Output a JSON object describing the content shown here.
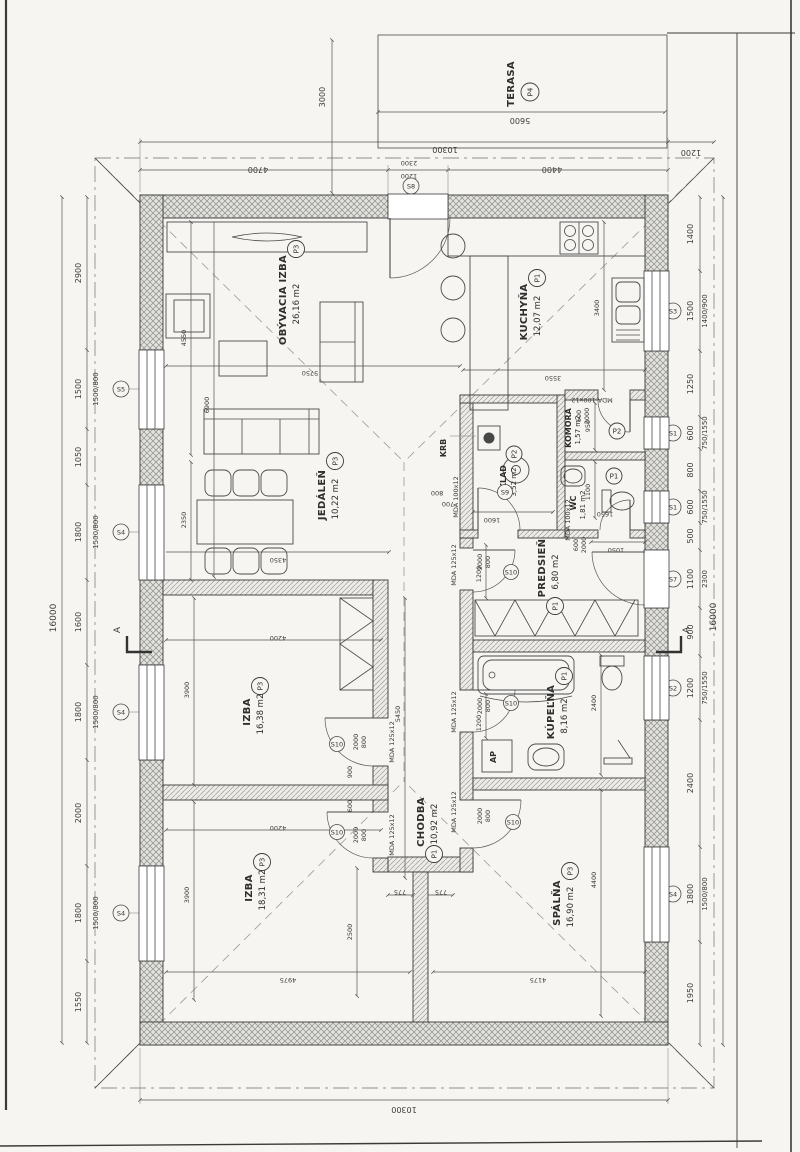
{
  "rooms": {
    "obyvacia": {
      "name": "OBÝVACIA IZBA",
      "tag": "P3",
      "area": "26,16 m2"
    },
    "kuchyna": {
      "name": "KUCHYŇA",
      "tag": "P1",
      "area": "12,07 m2"
    },
    "jedalen": {
      "name": "JEDÁLEŇ",
      "tag": "P3",
      "area": "10,22 m2"
    },
    "sklad": {
      "name": "SKLAD",
      "tag": "P2",
      "area": "3,52 m2"
    },
    "komora": {
      "name": "KOMORA",
      "tag": "P2",
      "area": "1,57 m2"
    },
    "wc": {
      "name": "WC",
      "tag": "P1",
      "area": "1,81 m2"
    },
    "predsien": {
      "name": "PREDSIEŇ",
      "tag": "P1",
      "area": "6,80 m2"
    },
    "izba1": {
      "name": "IZBA",
      "tag": "P3",
      "area": "16,38 m2"
    },
    "chodba": {
      "name": "CHODBA",
      "tag": "P1",
      "area": "10,92 m2"
    },
    "kupelna": {
      "name": "KÚPEĽŇA",
      "tag": "P1",
      "area": "8,16 m2"
    },
    "izba2": {
      "name": "IZBA",
      "tag": "P3",
      "area": "18,31 m2"
    },
    "spalna": {
      "name": "SPÁLŇA",
      "tag": "P3",
      "area": "16,90 m2"
    },
    "terasa": {
      "name": "TERASA",
      "tag": "P4"
    }
  },
  "features": {
    "krb": "KRB",
    "ap": "AP",
    "section_left": "A",
    "section_right": "A"
  },
  "overall": {
    "height_left": "16000",
    "height_right": "16000",
    "width_top": "10300",
    "width_bottom": "10300"
  },
  "top_chain": {
    "left": "4700",
    "door_w": "1200",
    "door_h": "2300",
    "right": "4400",
    "door_mark": "S8",
    "overhang": "1200"
  },
  "terrace_dims": {
    "width": "5600",
    "depth": "3000"
  },
  "left_chain": {
    "c0": "2900",
    "c1": "1500",
    "c2": "1050",
    "c3": "1800",
    "c4": "1600",
    "c5": "1800",
    "c6": "2000",
    "c7": "1800",
    "c8": "1550",
    "w1": "1500/800",
    "w3": "1500/800",
    "w5": "1500/800",
    "w7": "1500/800",
    "m1": "S5",
    "m3": "S4",
    "m5": "S4",
    "m7": "S4"
  },
  "right_chain": {
    "c0": "1400",
    "c1": "1500",
    "c2": "1250",
    "c3": "600",
    "c4": "800",
    "c5": "600",
    "c6": "500",
    "c7": "1100",
    "c8": "900",
    "c9": "1200",
    "c10": "2400",
    "c11": "1800",
    "c12": "1950",
    "w1": "1400/900",
    "w3": "750/1550",
    "w5": "750/1550",
    "w7": "2300",
    "w9": "750/1550",
    "w11": "1500/800",
    "m1": "S3",
    "m3": "S1",
    "m5": "S1",
    "m7": "S7",
    "m9": "S2",
    "m11": "S4"
  },
  "interior": {
    "living_depth": "4550",
    "living_depth2": "6900",
    "living_width": "5750",
    "kitchen_depth": "3400",
    "kitchen_width": "3550",
    "jedalen_depth": "2350",
    "jedalen_width": "4350",
    "izba1_depth": "3900",
    "izba1_width": "4200",
    "izba2_depth": "3900",
    "izba2_width": "4200",
    "izba2_width2": "4975",
    "izba2_mid": "2500",
    "chodba_len": "5450",
    "chodba_half_a": "775",
    "chodba_half_b": "775",
    "spalna_width": "4175",
    "spalna_depth": "4400",
    "kupelna_depth": "2400",
    "kupelna_width": "1200",
    "predsien_depth": "1200",
    "predsien_off": "1050",
    "komora_width": "950",
    "wc_width": "1100",
    "wc_off": "1650",
    "sklad_width": "1600",
    "sklad_d1": "700",
    "sklad_d2": "800"
  },
  "doors": {
    "izba1": {
      "code": "MDA 125x12",
      "h": "2000",
      "w": "800",
      "x": "900",
      "mark": "S10"
    },
    "izba2": {
      "code": "MDA 125x12",
      "h": "2000",
      "w": "800",
      "x": "600",
      "mark": "S10"
    },
    "spalna": {
      "code": "MDA 125x12",
      "h": "2000",
      "w": "800",
      "mark": "S10"
    },
    "kupelna": {
      "code": "MDA 125x12",
      "h": "2000",
      "w": "800",
      "mark": "S10"
    },
    "jedalen": {
      "code": "MDA 125x12",
      "h": "2000",
      "w": "800",
      "mark": "S10"
    },
    "komora": {
      "code": "MDA 100x12",
      "h": "2000",
      "w": "600"
    },
    "wc": {
      "code": "MDA 100x12",
      "h": "2000",
      "w": "600"
    },
    "sklad": {
      "code": "MDA 100x12",
      "mark": "S9"
    }
  }
}
